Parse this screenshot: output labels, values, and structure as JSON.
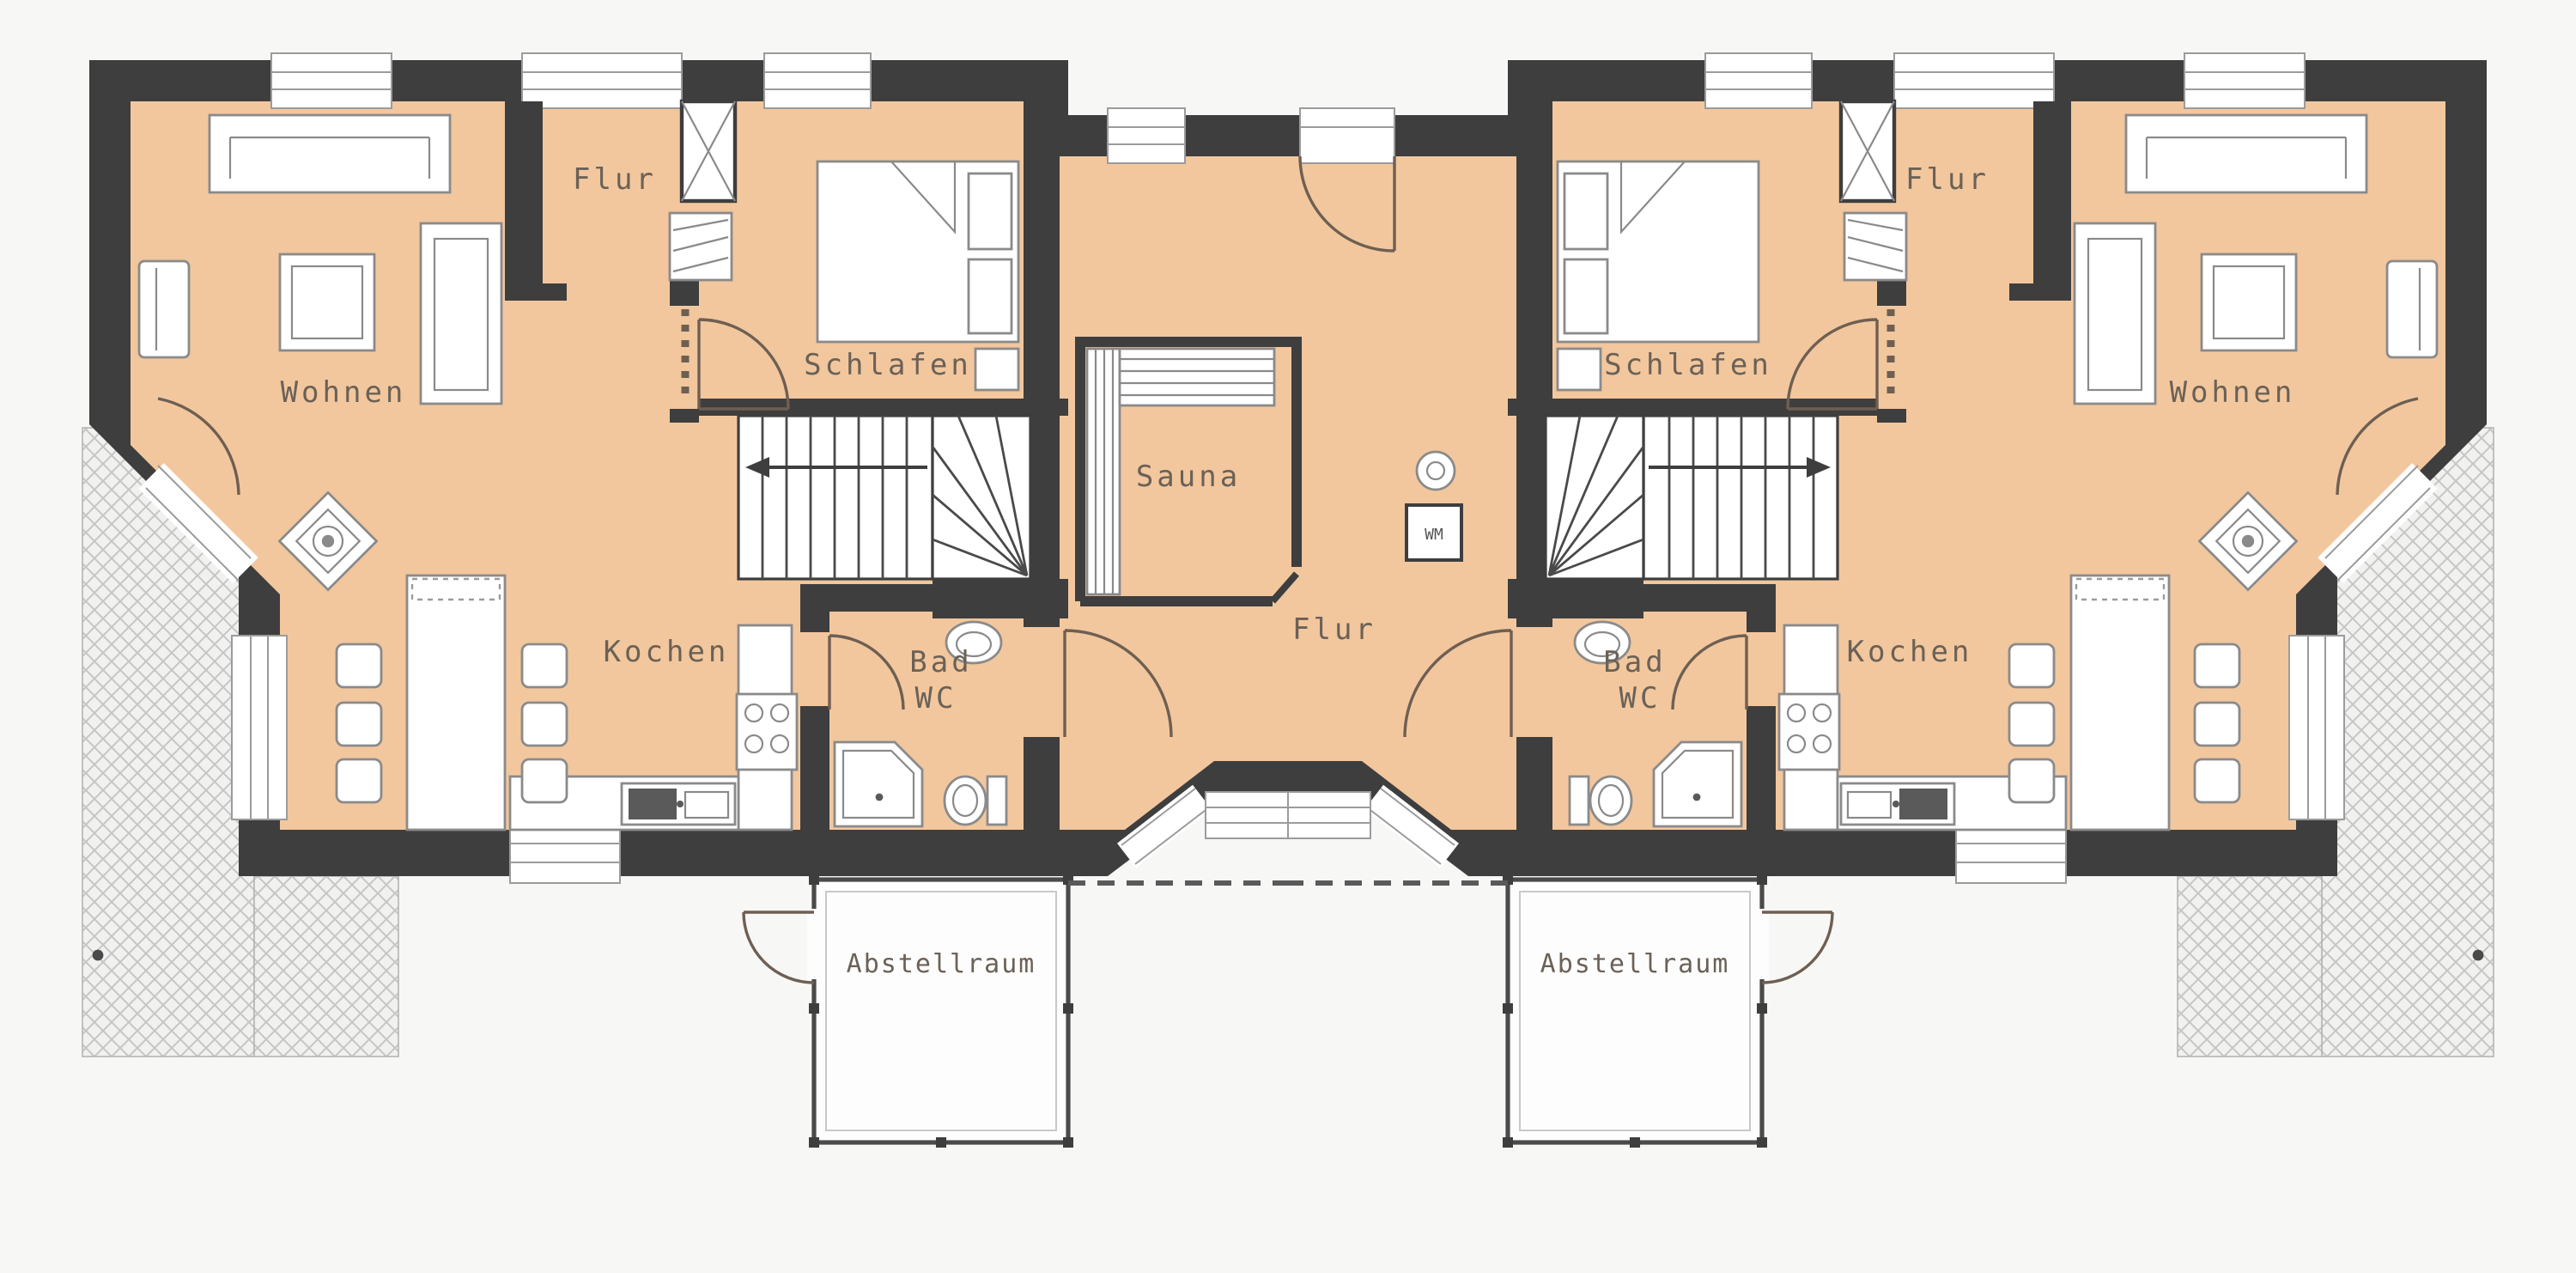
{
  "document": {
    "type": "architectural-floor-plan",
    "subject": "Ground floor plan of a mirrored duplex house with sauna, entry porch, storage annexes and terraces"
  },
  "colors": {
    "floor_fill": "#F2C79E",
    "wall_fill": "#3E3E3E",
    "background": "#F7F7F6",
    "terrace_hatch_line": "#C6C6C6",
    "furniture_stroke": "#8A8A8A",
    "label_text": "#6B6156"
  },
  "rooms": {
    "left": {
      "wohnen": "Wohnen",
      "flur": "Flur",
      "schlafen": "Schlafen",
      "kochen": "Kochen",
      "bad_line1": "Bad",
      "bad_line2": "WC",
      "abstellraum": "Abstellraum"
    },
    "right": {
      "wohnen": "Wohnen",
      "flur": "Flur",
      "schlafen": "Schlafen",
      "kochen": "Kochen",
      "bad_line1": "Bad",
      "bad_line2": "WC",
      "abstellraum": "Abstellraum"
    },
    "center": {
      "sauna": "Sauna",
      "flur": "Flur",
      "washing_machine": "WM"
    }
  }
}
